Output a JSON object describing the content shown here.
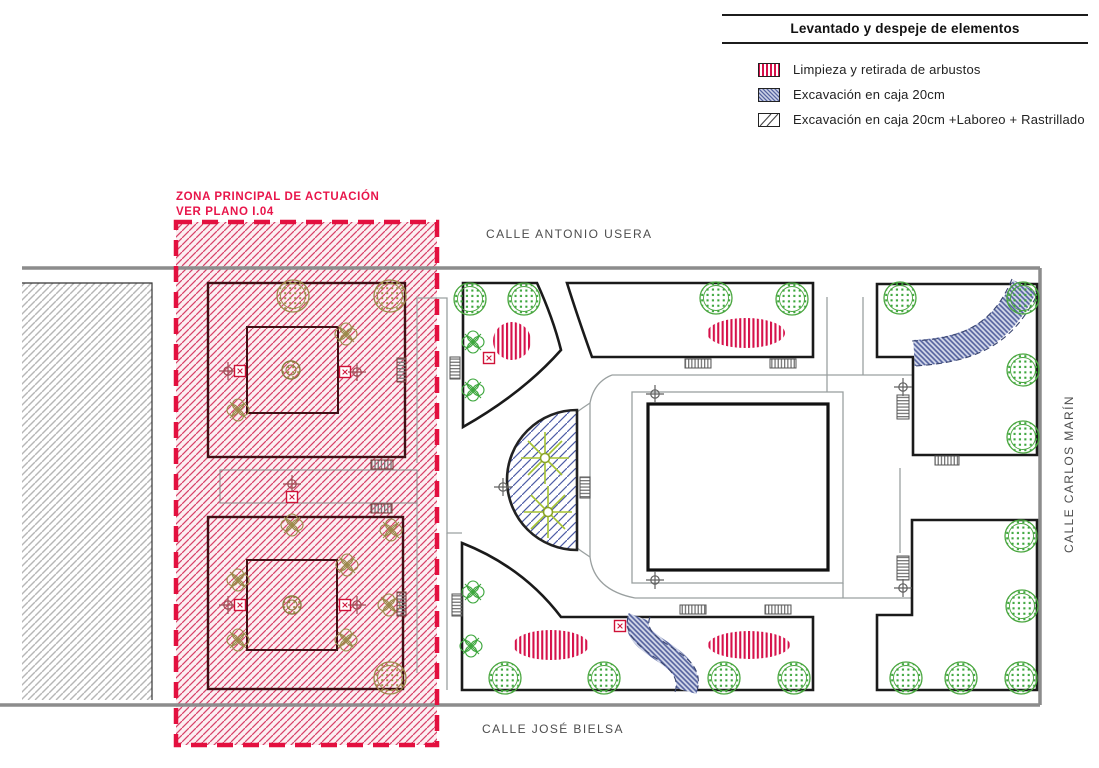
{
  "legend": {
    "title": "Levantado y despeje de elementos",
    "items": [
      {
        "label": "Limpieza y retirada de arbustos",
        "swatch": "pink-vertical-stripes",
        "color": "#d6114a"
      },
      {
        "label": "Excavación en caja 20cm",
        "swatch": "blue-diagonal-hatch",
        "color": "#55639f"
      },
      {
        "label": "Excavación en caja 20cm +Laboreo + Rastrillado",
        "swatch": "white-diagonal-lines",
        "color": "#333333"
      }
    ]
  },
  "zone": {
    "line1": "ZONA PRINCIPAL DE ACTUACIÓN",
    "line2": "VER PLANO I.04"
  },
  "streets": {
    "top": "CALLE ANTONIO USERA",
    "bottom": "CALLE JOSÉ BIELSA",
    "right": "CALLE CARLOS MARÍN"
  },
  "features": {
    "tree_icon": "green-dotted-circle",
    "shrub_removal_icon": "pink-striped-oval",
    "excavation_icon": "blue-hatched-band",
    "palm_icon": "yellow-green-starburst",
    "bench_icon": "striped-rectangle",
    "survey_point_icon": "crosshair",
    "marker_icon": "small-red-square"
  },
  "colors": {
    "zone_border": "#e3103f",
    "zone_hatch": "#d84068",
    "excavation_blue": "#55639f",
    "tree_green": "#3ca63c",
    "existing_tree_tan": "#a2914f",
    "boundary_gray": "#8c8c8c",
    "shrub_pink": "#d6114a"
  }
}
